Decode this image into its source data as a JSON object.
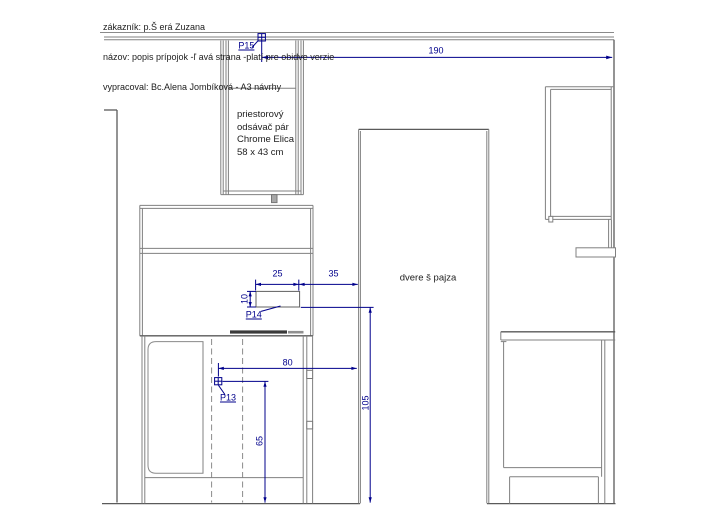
{
  "header": {
    "line1": "zákazník: p.Š erá Zuzana",
    "line2": "názov: popis prípojok -ľ avá strana -platí pre obidve verzie",
    "line3": "vypracoval: Bc.Alena Jombíková - A3 návrhy"
  },
  "hood_label": {
    "line1": "priestorový",
    "line2": "odsávač  pár",
    "line3": "Chrome Elica",
    "line4": "58 x 43 cm"
  },
  "door_label": "dvere š pajza",
  "dimensions": {
    "width_total": "190",
    "outlet_width": "25",
    "outlet_offset": "35",
    "outlet_height": "10",
    "p13_offset": "80",
    "p13_height": "65",
    "p14_height": "105"
  },
  "points": {
    "p13": "P13",
    "p14": "P14",
    "p15": "P15"
  },
  "colors": {
    "dimension": "#00008b",
    "line_gray": "#808080",
    "line_dark": "#5a5a5a"
  }
}
